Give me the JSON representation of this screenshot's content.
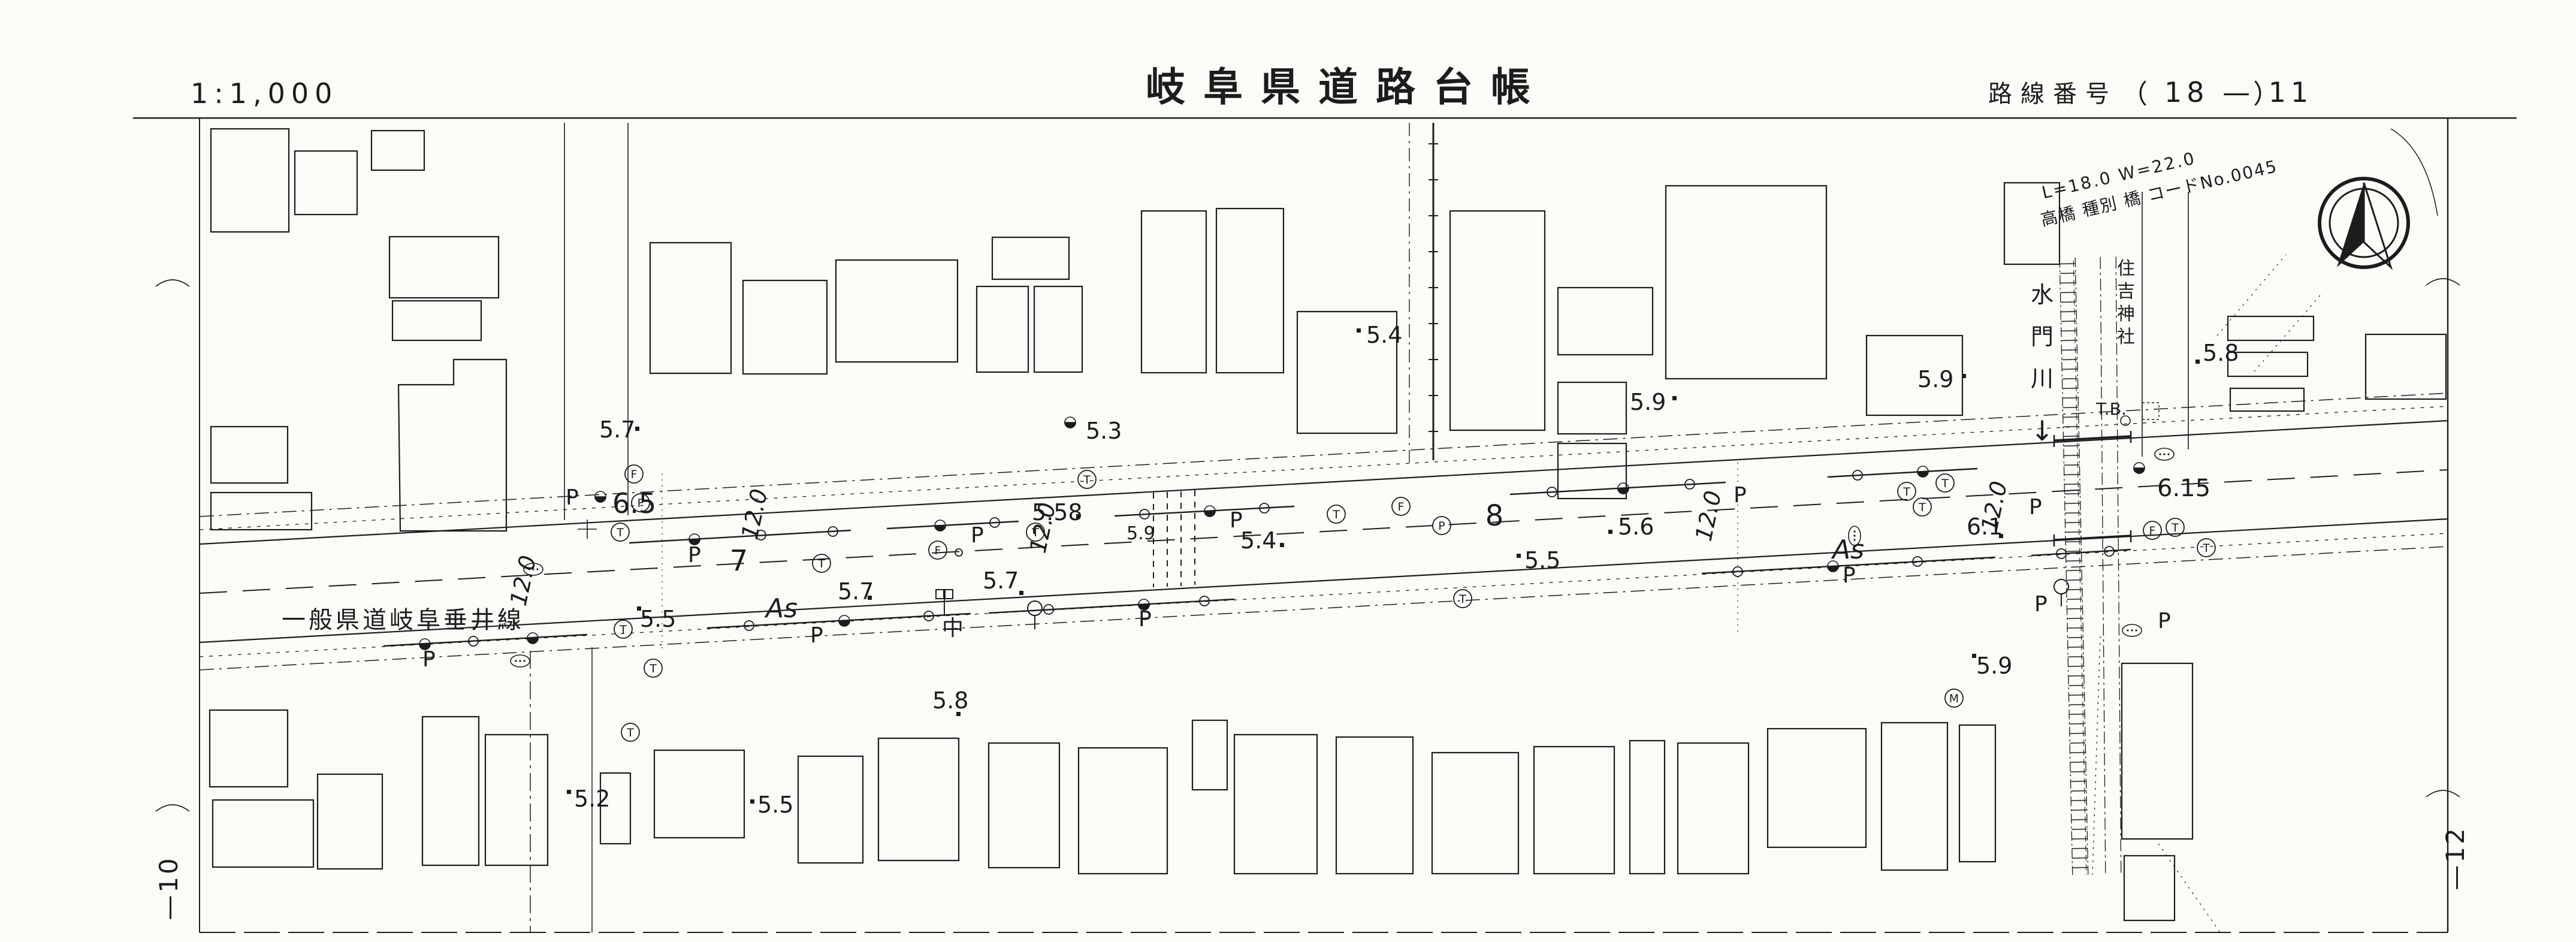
{
  "header": {
    "scale": "1:1,000",
    "title": "岐阜県道路台帳",
    "route_label": "路線番号",
    "paren_open": "（",
    "route_value": "18 — 11",
    "paren_close": "）"
  },
  "notes": {
    "bridge_line1": "L=18.0  W=22.0",
    "bridge_line2": "高橋 種別 橋 コードNo.0045"
  },
  "sheet": {
    "left_no": "—10",
    "right_no": "—12"
  },
  "map": {
    "road_name": "一般県道岐阜垂井線",
    "river": {
      "c0": "水",
      "c1": "門",
      "c2": "川",
      "arrow": "↓"
    },
    "shrine": {
      "c0": "住",
      "c1": "吉",
      "c2": "神",
      "c3": "社"
    },
    "tb": "T.B.",
    "surface_as": "As",
    "center_mark": "中",
    "width_label": "12.0",
    "p_label": "P",
    "sym_t": "T",
    "sym_f": "F",
    "sym_m": "M",
    "sym_p": "P",
    "stations": {
      "s7": "7",
      "s8": "8"
    },
    "elev": {
      "e57a": "5.7",
      "e65": "6.5",
      "e55a": "5.5",
      "e52": "5.2",
      "e55b": "5.5",
      "e58a": "5.8",
      "e57b": "5.7",
      "e57c": "5.7",
      "e53": "5.3",
      "e558": "5.58",
      "e59w": "5.9",
      "e54a": "5.4",
      "e54b": "5.4",
      "e59a": "5.9",
      "e59b": "5.9",
      "e56": "5.6",
      "e55c": "5.5",
      "e61": "6.1",
      "e615": "6.15",
      "e59c": "5.9",
      "e58b": "5.8"
    }
  },
  "colors": {
    "ink": "#1c1c1c",
    "paper": "#fbfbf8"
  }
}
